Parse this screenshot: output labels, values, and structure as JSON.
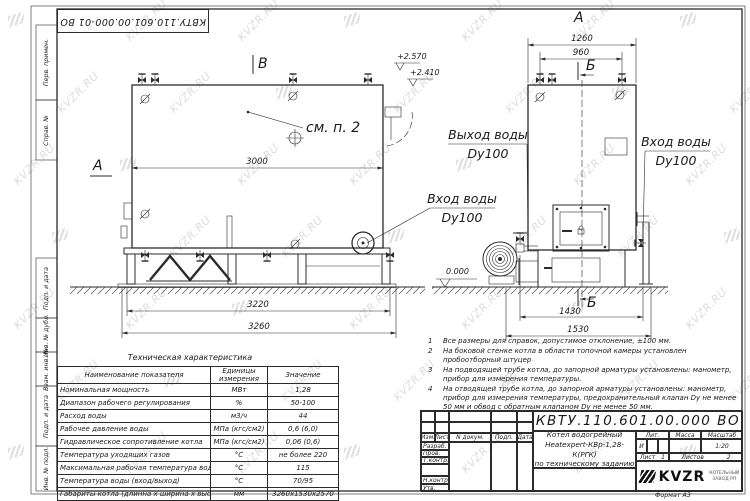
{
  "watermark": {
    "text": "KVZR.RU"
  },
  "corner_stamp": {
    "text": "КВТУ.110.601.00.000-01  ВО"
  },
  "frame": {
    "left_labels": [
      "Перв. примен.",
      "Справ. №",
      "Подп. и дата",
      "Инв. № дубл.",
      "Взам. инв. №",
      "Подп. и дата",
      "Инв. № подл."
    ]
  },
  "drawing": {
    "marker_b_top": "В",
    "marker_a_left": "А",
    "view_a": "А",
    "marker_b1": "Б",
    "marker_b2": "Б",
    "see_item": "см. п. 2",
    "elev_top1": "+2.570",
    "elev_top2": "+2.410",
    "elev_zero": "0.000",
    "dims": {
      "d3000": "3000",
      "d3220": "3220",
      "d3260": "3260",
      "d1260": "1260",
      "d960": "960",
      "d1430": "1430",
      "d1530": "1530"
    },
    "outlet": {
      "line1": "Выход воды",
      "line2": "Dy100"
    },
    "inlet_side": {
      "line1": "Вход воды",
      "line2": "Dy100"
    },
    "inlet_front": {
      "line1": "Вход воды",
      "line2": "Dy100"
    }
  },
  "tech_table": {
    "title": "Техническая характеристика",
    "col_name": "Наименование показателя",
    "col_units_1": "Единицы",
    "col_units_2": "измерения",
    "col_value": "Значение",
    "rows": [
      {
        "name": "Номинальная мощность",
        "units": "МВт",
        "value": "1,28"
      },
      {
        "name": "Диапазон рабочего регулирования",
        "units": "%",
        "value": "50-100"
      },
      {
        "name": "Расход воды",
        "units": "м3/ч",
        "value": "44"
      },
      {
        "name": "Рабочее давление воды",
        "units": "МПа (кгс/см2)",
        "value": "0,6 (6,0)"
      },
      {
        "name": "Гидравлическое сопротивление котла",
        "units": "МПа (кгс/см2)",
        "value": "0,06 (0,6)"
      },
      {
        "name": "Температура уходящих газов",
        "units": "°С",
        "value": "не более 220"
      },
      {
        "name": "Максимальная рабочая температура воды",
        "units": "°С",
        "value": "115"
      },
      {
        "name": "Температура воды (вход/выход)",
        "units": "°С",
        "value": "70/95"
      },
      {
        "name": "Габариты котла (длинна х ширина х высота)",
        "units": "мм",
        "value": "3260х1530х2570"
      }
    ]
  },
  "notes": [
    {
      "num": "1",
      "text": "Все размеры для справок, допустимое отклонение, ±100 мм."
    },
    {
      "num": "2",
      "text": "На боковой стенке котла в области топочной камеры установлен пробоотборный штуцер"
    },
    {
      "num": "3",
      "text": "На  подводящей трубе котла, до запорной арматуры установлены: манометр, прибор для измерения температуры."
    },
    {
      "num": "4",
      "text": "На отводящей трубе котла, до запорной арматуры установлены: манометр, прибор для измерения температуры, предохранительный клапан Dy не менее 50 мм и обвод с обратным клапаном Dy не менее 50 мм."
    }
  ],
  "title_block": {
    "designation": "КВТУ.110.601.00.000  ВО",
    "change_cols": [
      "Изм.",
      "Лист",
      "N докум.",
      "Подп.",
      "Дата"
    ],
    "staff_rows": [
      "Разраб.",
      "Пров.",
      "Т.контр.",
      "",
      "Н.контр.",
      "Утв."
    ],
    "name_line1": "Котел водогрейный",
    "name_line2": "Heatexpert-КВр-1,28-К(РГК)",
    "name_line3": "по техническому заданию",
    "lit_label": "Лит.",
    "lit_value": "И",
    "mass_label": "Масса",
    "scale_label": "Масштаб",
    "scale_value": "1:20",
    "sheet_label": "Лист",
    "sheet_value": "1",
    "sheets_label": "Листов",
    "sheets_value": "2",
    "logo_text": "KVZR",
    "logo_sub1": "КОТЕЛЬНЫЙ",
    "logo_sub2": "ЗАВОД РП",
    "format_text": "Формат  А3"
  }
}
